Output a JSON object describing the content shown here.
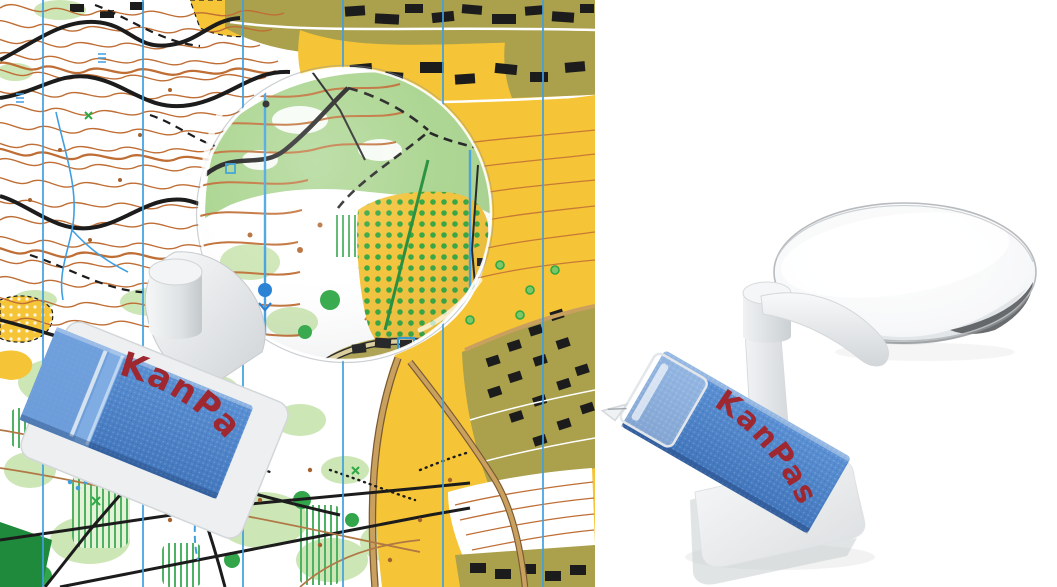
{
  "brand": "KanPas",
  "left_photo": {
    "strap_label": "KanPas"
  },
  "right_photo": {
    "strap_label": "KanPas"
  },
  "colors": {
    "background": "#FFFFFF",
    "strap_blue": "#4C86CA",
    "strap_blue_light": "#74A3DE",
    "logo_red": "#9E2730",
    "plastic_white": "#F4F5F6",
    "plastic_shadow": "#D6D9DB",
    "map_yellow": "#F5C437",
    "map_olive": "#ABA04C",
    "map_light_green": "#CDE6B5",
    "map_mid_green": "#A9D48E",
    "map_green": "#33A64C",
    "map_dark_green_line": "#1E8A35",
    "map_contour_orange": "#BF6E35",
    "map_north_blue": "#3F9FE0",
    "map_black": "#1C1C1C",
    "map_road_tan": "#C9A05E"
  }
}
